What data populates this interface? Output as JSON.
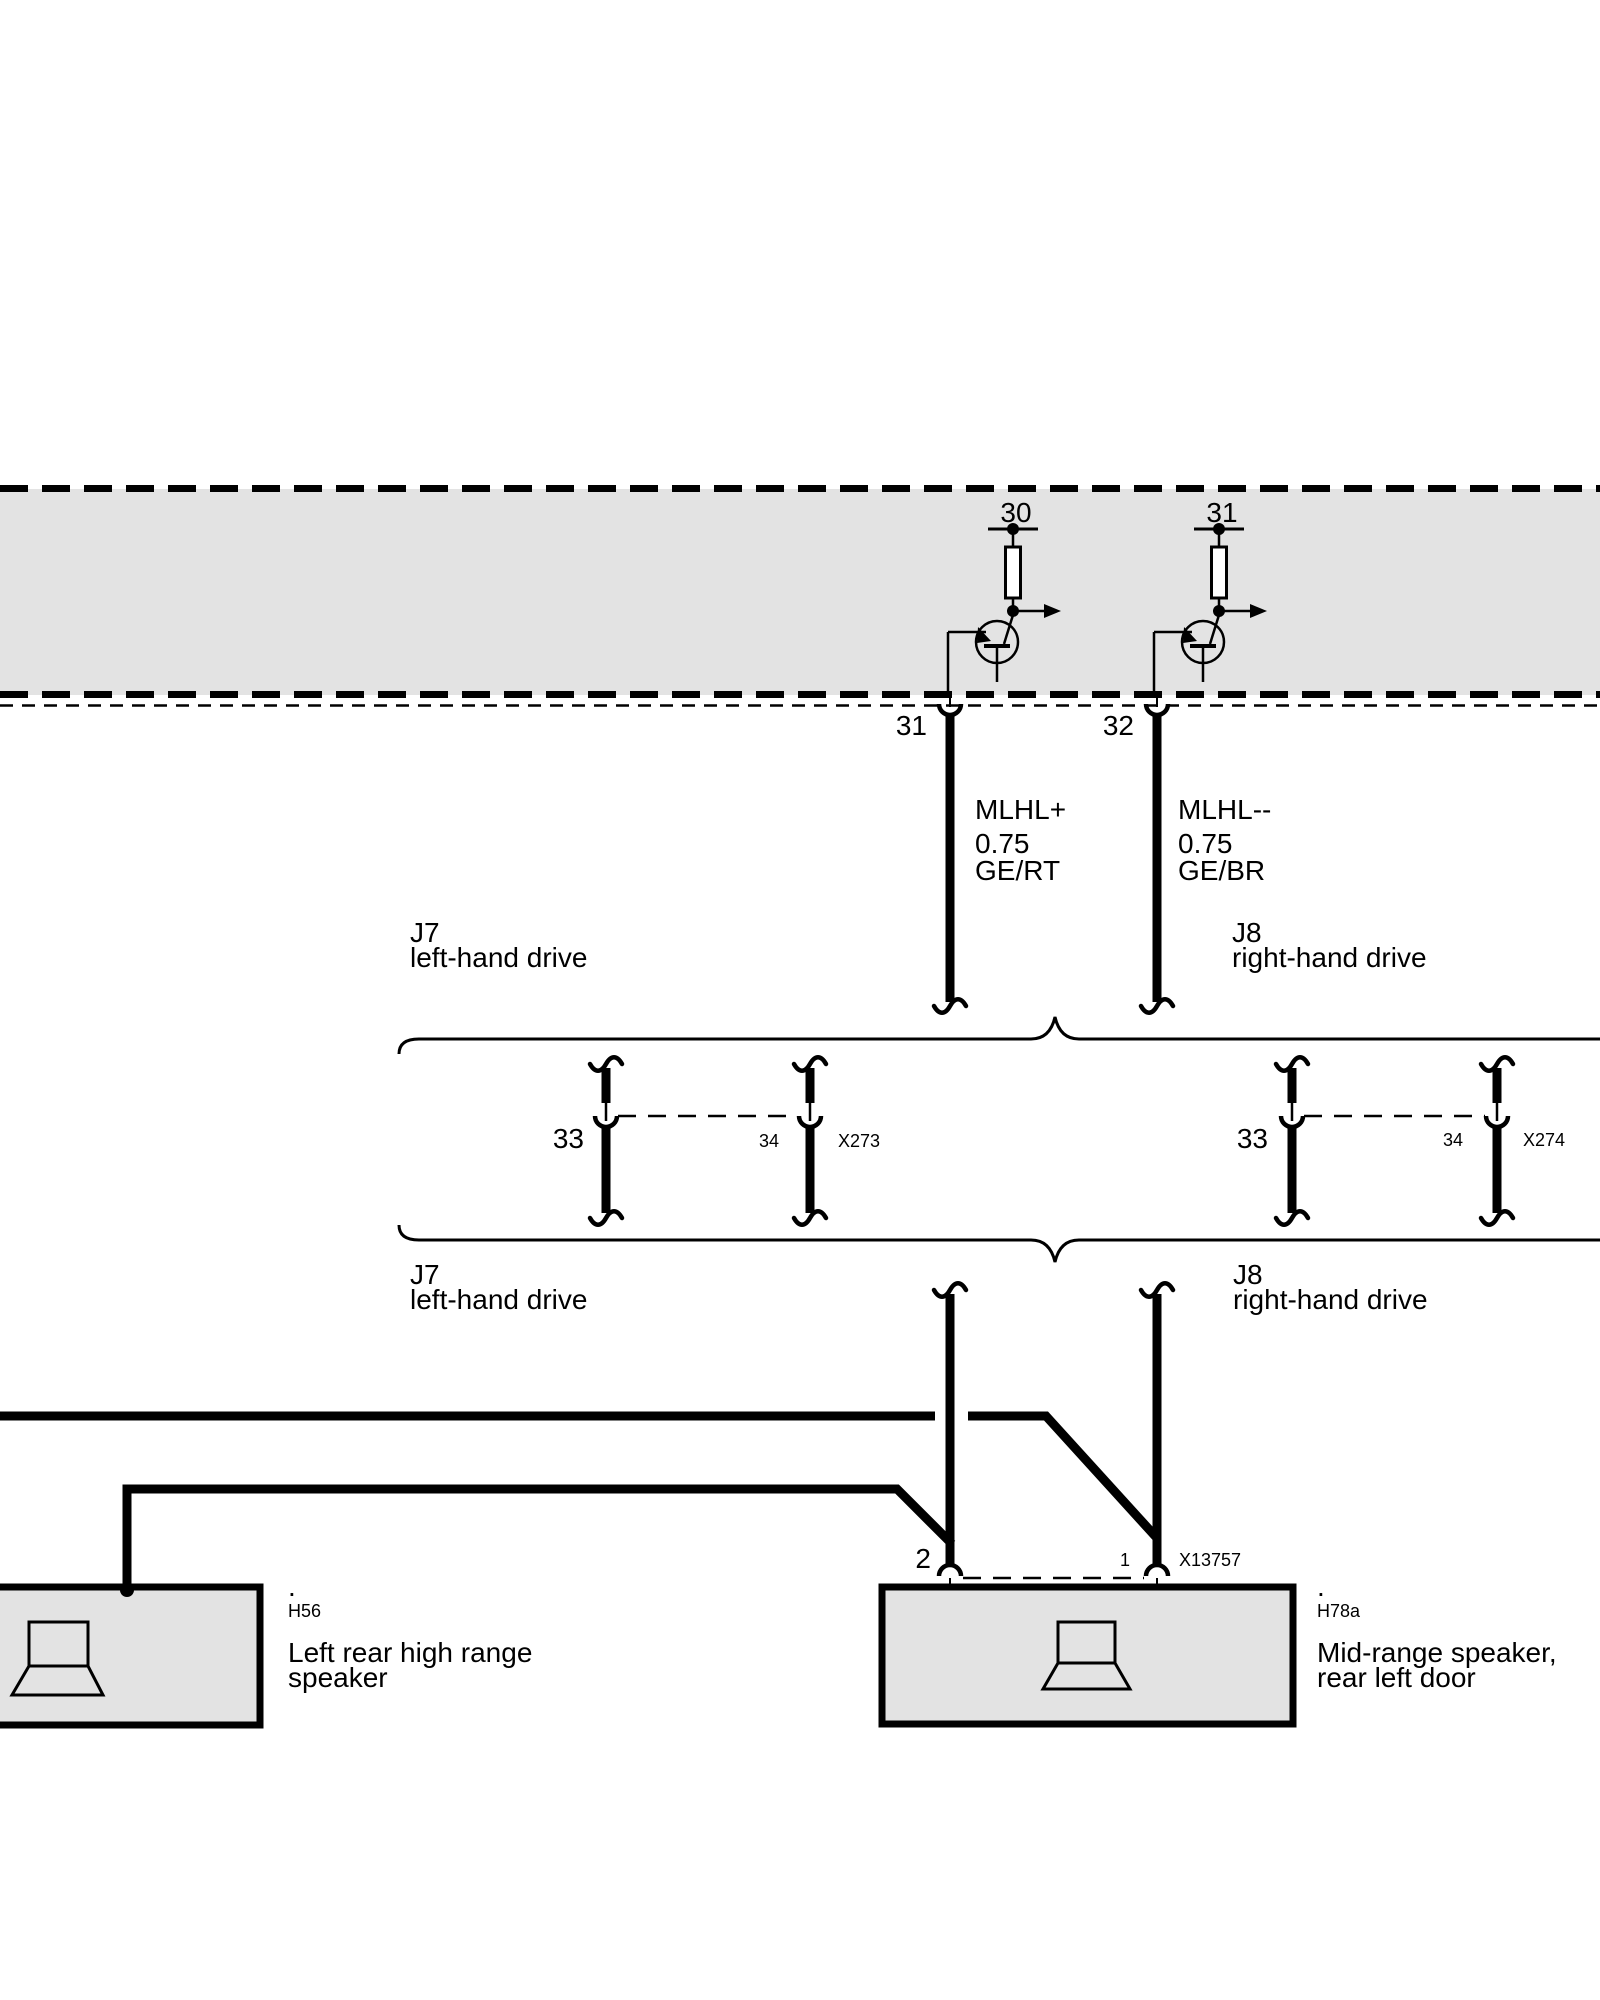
{
  "module": {
    "pin_top_left": "30",
    "pin_top_right": "31",
    "pin_out_left": "31",
    "pin_out_right": "32"
  },
  "wires": {
    "left": {
      "signal": "MLHL+",
      "cross_section": "0.75",
      "color_code": "GE/RT"
    },
    "right": {
      "signal": "MLHL--",
      "cross_section": "0.75",
      "color_code": "GE/BR"
    }
  },
  "variants": {
    "left": {
      "code": "J7",
      "description": "left-hand drive"
    },
    "right": {
      "code": "J8",
      "description": "right-hand drive"
    }
  },
  "connectors": {
    "x273": {
      "pin_main": "33",
      "pin_inline": "34",
      "code": "X273"
    },
    "x274": {
      "pin_main": "33",
      "pin_inline": "34",
      "code": "X274"
    },
    "x13757": {
      "pin_main": "2",
      "pin_inline": "1",
      "code": "X13757"
    }
  },
  "components": {
    "h56": {
      "marker": ".",
      "id": "H56",
      "name_line1": "Left rear high range",
      "name_line2": "speaker"
    },
    "h78a": {
      "marker": ".",
      "id": "H78a",
      "name_line1": "Mid-range speaker,",
      "name_line2": "rear left door"
    }
  },
  "icons": {
    "h56": "speaker-icon",
    "h78a": "speaker-icon"
  },
  "colors": {
    "module_fill": "#e3e3e3",
    "component_fill": "#e3e3e3",
    "line": "#000000",
    "background": "#ffffff"
  }
}
